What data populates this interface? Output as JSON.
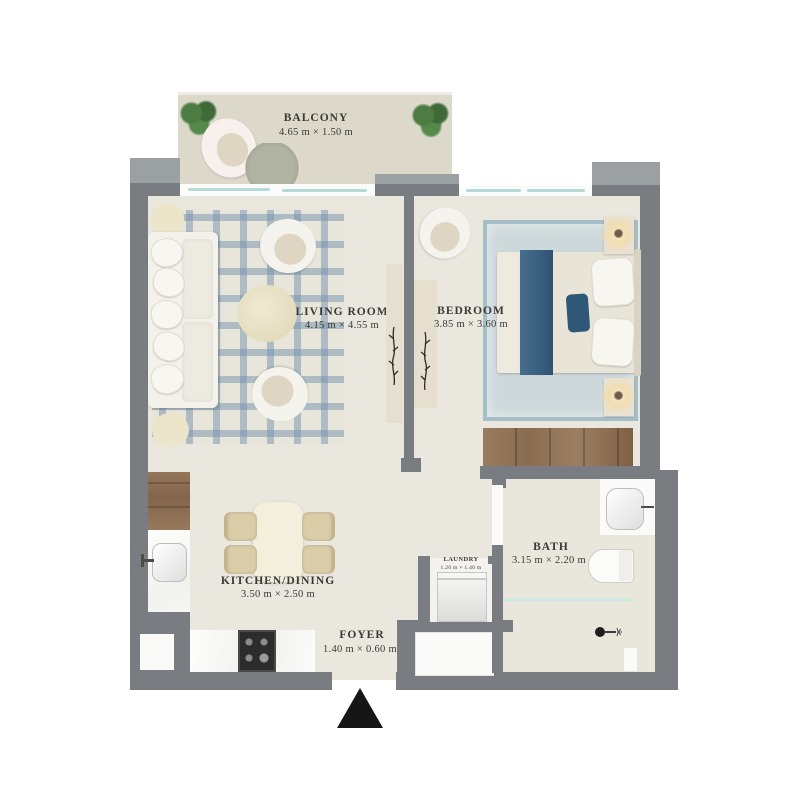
{
  "plan": {
    "type": "apartment-floor-plan",
    "rooms": [
      {
        "id": "balcony",
        "name": "BALCONY",
        "dims": "4.65 m × 1.50 m"
      },
      {
        "id": "living",
        "name": "LIVING ROOM",
        "dims": "4.15 m × 4.55 m"
      },
      {
        "id": "bedroom",
        "name": "BEDROOM",
        "dims": "3.85 m × 3.60 m"
      },
      {
        "id": "kitchen",
        "name": "KITCHEN/DINING",
        "dims": "3.50 m × 2.50 m"
      },
      {
        "id": "bath",
        "name": "BATH",
        "dims": "3.15 m × 2.20 m"
      },
      {
        "id": "laundry",
        "name": "LAUNDRY",
        "dims": "1.20 m × 1.40 m"
      },
      {
        "id": "foyer",
        "name": "FOYER",
        "dims": "1.40 m × 0.60 m"
      }
    ],
    "icons": {
      "entrance_marker": "black-up-triangle",
      "shower_head": "shower-icon",
      "lamps": "glowing-table-lamps",
      "plants": "balcony-potted-plants"
    },
    "colors": {
      "wall": "#797d81",
      "wall_highlight": "#9ba0a3",
      "floor": "#eae7de",
      "balcony_floor": "#dcd8ca",
      "bed_accent_blue": "#3e6482",
      "plaid_rug_blue": "#7492ac",
      "bedroom_rug": "#cdd8da",
      "wood": "#96775a",
      "glass": "#b5dad8",
      "entrance_marker": "#161616"
    }
  }
}
